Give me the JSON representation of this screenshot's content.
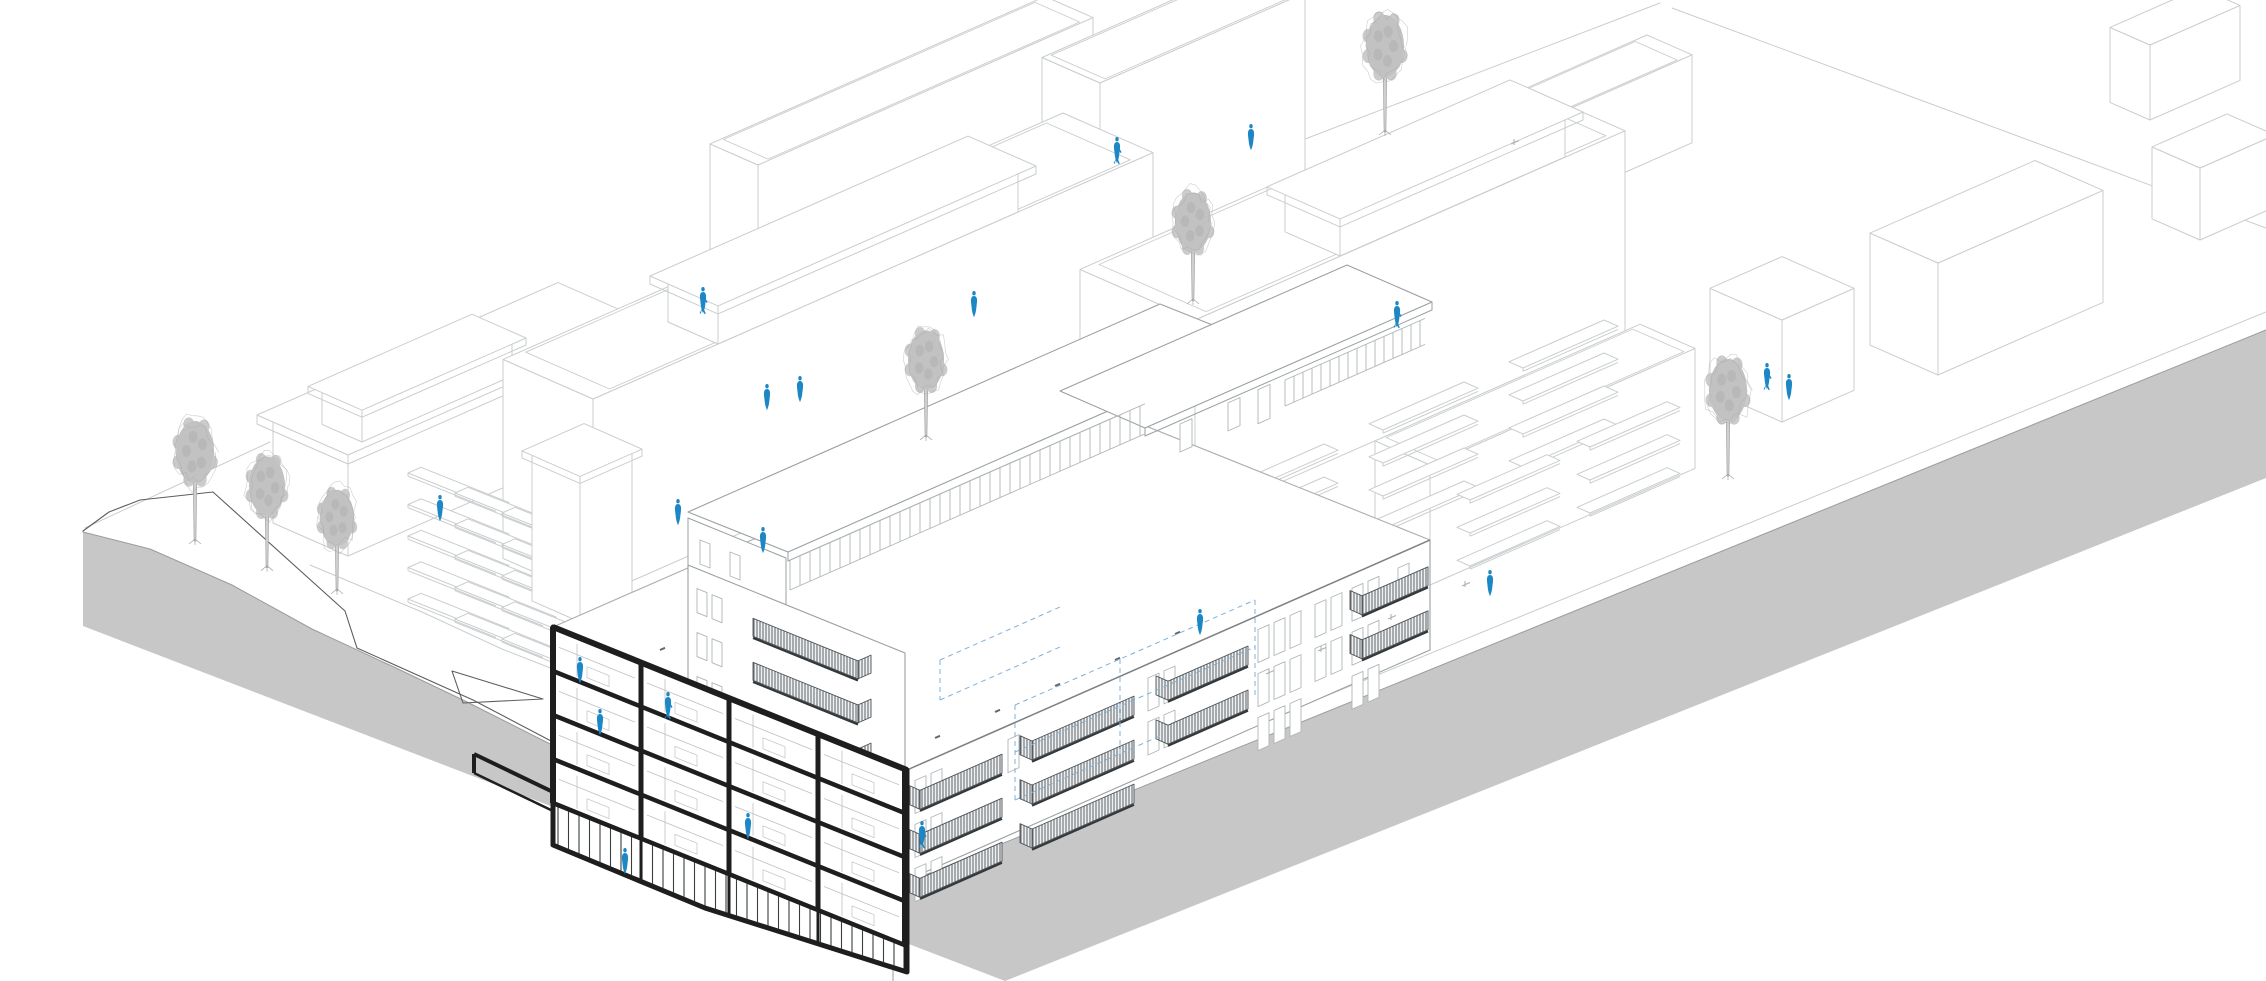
{
  "scene": {
    "width": 2266,
    "height": 981,
    "slopes": {
      "e1": 0.44,
      "e2": 0.4
    },
    "colors": {
      "bg": "#ffffff",
      "lineLight": "#c9cdcf",
      "lineMid": "#a9aeb1",
      "lineDark": "#5b5f61",
      "black": "#1e1e1e",
      "plinth": "#c7c7c7",
      "plinthEdge": "#9c9c9c",
      "treeFill": "#c2c2c2",
      "treeMottle": "#adadad",
      "treeStroke": "#a6a6a6",
      "person": "#1d87c6",
      "dash": "#7fb0d8",
      "hatchLine": "#5d6367",
      "hatchBg": "#eef0f1",
      "windowLine": "#b0b5b7",
      "interior": "#bcc1c3",
      "storefront": "#3a3e40",
      "dots": "#63686b",
      "facadeLine": "#9aa0a3",
      "roofEdge": "#7c8184"
    },
    "plinth": {
      "polygon": [
        [
          83,
          532
        ],
        [
          150,
          549
        ],
        [
          232,
          585
        ],
        [
          312,
          629
        ],
        [
          396,
          668
        ],
        [
          465,
          701
        ],
        [
          560,
          749
        ],
        [
          648,
          791
        ],
        [
          762,
          841
        ],
        [
          893,
          888
        ],
        [
          2266,
          330
        ],
        [
          2266,
          478
        ],
        [
          1005,
          981
        ],
        [
          83,
          626
        ]
      ],
      "topEdge": [
        [
          83,
          532
        ],
        [
          150,
          549
        ],
        [
          232,
          585
        ],
        [
          312,
          629
        ],
        [
          396,
          668
        ],
        [
          465,
          701
        ],
        [
          560,
          749
        ],
        [
          648,
          791
        ],
        [
          762,
          841
        ],
        [
          893,
          888
        ],
        [
          2266,
          330
        ]
      ],
      "cornerLine": [
        [
          893,
          888
        ],
        [
          893,
          981
        ]
      ]
    },
    "siteLines": [
      [
        [
          85,
          528
        ],
        [
          270,
          442
        ]
      ],
      [
        [
          1050,
          237
        ],
        [
          1172,
          190
        ],
        [
          1660,
          3
        ]
      ],
      [
        [
          1672,
          8
        ],
        [
          2266,
          228
        ]
      ],
      [
        [
          310,
          565
        ],
        [
          422,
          612
        ],
        [
          502,
          649
        ],
        [
          553,
          669
        ]
      ],
      [
        [
          900,
          870
        ],
        [
          2266,
          312
        ]
      ]
    ],
    "darkPaths": [
      [
        [
          140,
          500
        ],
        [
          213,
          492
        ],
        [
          345,
          611
        ],
        [
          357,
          648
        ],
        [
          473,
          700
        ],
        [
          572,
          752
        ],
        [
          664,
          800
        ],
        [
          790,
          851
        ],
        [
          893,
          888
        ]
      ],
      [
        [
          140,
          500
        ],
        [
          109,
          512
        ],
        [
          83,
          531
        ]
      ]
    ],
    "darkClosed": [
      [
        [
          452,
          671
        ],
        [
          543,
          699
        ],
        [
          463,
          703
        ]
      ]
    ],
    "boxes": [
      {
        "n": [
          758,
          270
        ],
        "l1": 335,
        "l2": 48,
        "h": 105,
        "parapet": true
      },
      {
        "n": [
          1100,
          300
        ],
        "l1": 205,
        "l2": 58,
        "h": 217,
        "parapet": true
      },
      {
        "n": [
          1312,
          310
        ],
        "l1": 380,
        "l2": 45,
        "h": 88,
        "parapet": true
      },
      {
        "n": [
          348,
          556
        ],
        "l1": 285,
        "l2": 75,
        "h": 108,
        "slab": {
          "o": 8,
          "th": 9
        }
      },
      {
        "n": [
          362,
          442
        ],
        "l1": 150,
        "l2": 40,
        "h": 38,
        "slab": {
          "o": 7,
          "th": 7
        }
      },
      {
        "n": [
          593,
          598
        ],
        "l1": 560,
        "l2": 90,
        "h": 199,
        "parapet": true
      },
      {
        "n": [
          718,
          344
        ],
        "l1": 300,
        "l2": 50,
        "h": 46,
        "slab": {
          "o": 9,
          "th": 8
        }
      },
      {
        "n": [
          1430,
          585
        ],
        "l1": 265,
        "l2": 55,
        "h": 120,
        "parapet": true
      },
      {
        "n": [
          1195,
          520
        ],
        "l1": 430,
        "l2": 115,
        "h": 200,
        "parapet": true
      },
      {
        "n": [
          1340,
          256
        ],
        "l1": 225,
        "l2": 55,
        "h": 45,
        "slab": {
          "o": 9,
          "th": 8
        }
      },
      {
        "n": [
          2150,
          120
        ],
        "l1": 90,
        "l2": 40,
        "h": 75
      },
      {
        "n": [
          2200,
          240
        ],
        "l1": 75,
        "l2": 48,
        "h": 72
      },
      {
        "n": [
          1938,
          375
        ],
        "l1": 165,
        "l2": 68,
        "h": 112
      },
      {
        "n": [
          1782,
          422
        ],
        "l1": 72,
        "l2": 72,
        "h": 102
      }
    ],
    "towerBox": {
      "n": [
        580,
        622
      ],
      "l1": 52,
      "l2": 48,
      "h": 150,
      "slab": {
        "o": 5,
        "th": 7
      }
    },
    "stripGrids": [
      {
        "base": [
          408,
          473
        ],
        "dir": "sw",
        "len": 88,
        "dep": 13,
        "cols": 3,
        "rows": 5,
        "colStep": [
          47,
          20
        ],
        "rowStep": [
          0,
          31.5
        ]
      },
      {
        "base": [
          1243,
          492
        ],
        "dir": "se",
        "len": 95,
        "dep": 14,
        "cols": 3,
        "rows": 4,
        "colStep": [
          140,
          -62
        ],
        "rowStep": [
          0,
          33
        ]
      },
      {
        "base": [
          960,
          430
        ],
        "dir": "se",
        "len": 100,
        "dep": 13,
        "cols": 2,
        "rows": 3,
        "colStep": [
          130,
          -57
        ],
        "rowStep": [
          0,
          33
        ]
      },
      {
        "base": [
          1470,
          500
        ],
        "dir": "se",
        "len": 90,
        "dep": 13,
        "cols": 2,
        "rows": 3,
        "colStep": [
          120,
          -53
        ],
        "rowStep": [
          0,
          33
        ]
      }
    ],
    "detail": {
      "roofQuad": [
        [
          553,
          627
        ],
        [
          907,
          770
        ],
        [
          1430,
          540
        ],
        [
          1076,
          398
        ]
      ],
      "roofDots": [
        [
          935,
          738
        ],
        [
          995,
          712
        ],
        [
          1055,
          686
        ],
        [
          1115,
          660
        ],
        [
          1175,
          634
        ],
        [
          975,
          747
        ],
        [
          1095,
          695
        ],
        [
          1215,
          643
        ],
        [
          720,
          665
        ],
        [
          660,
          650
        ]
      ],
      "atticSlabA": {
        "quad": [
          [
            688,
            512
          ],
          [
            1160,
            304
          ],
          [
            1260,
            344
          ],
          [
            788,
            552
          ]
        ],
        "th": 9
      },
      "atticSlabB": {
        "quad": [
          [
            1060,
            391
          ],
          [
            1347,
            265
          ],
          [
            1432,
            302
          ],
          [
            1145,
            428
          ]
        ],
        "th": 8
      },
      "clerestories": [
        {
          "x1": 790,
          "y1": 560,
          "len": 355,
          "slope": -0.44,
          "h": 30,
          "sp": 10
        },
        {
          "x1": 1285,
          "y1": 380,
          "len": 140,
          "slope": -0.44,
          "h": 26,
          "sp": 9
        }
      ],
      "atticWindows": {
        "lineX": 1180,
        "lineY": 424,
        "slope": -0.44,
        "xs": [
          1180,
          1228
        ],
        "doorX": 1258,
        "w": 12,
        "h": 28,
        "doorH": 34
      },
      "atticEndWall": {
        "quad": [
          [
            688,
            518
          ],
          [
            786,
            558
          ],
          [
            786,
            624
          ],
          [
            688,
            584
          ]
        ],
        "windows": [
          [
            700,
            540
          ],
          [
            730,
            552
          ]
        ],
        "ww": 10,
        "wh": 24
      },
      "wing": {
        "quad": [
          [
            688,
            565
          ],
          [
            905,
            653
          ],
          [
            905,
            770
          ],
          [
            688,
            683
          ]
        ],
        "edge": {
          "x": 688,
          "y": 565,
          "s": 0.405
        },
        "rails": {
          "x": 753,
          "w": 105,
          "rows": [
            27,
            71,
            115
          ],
          "h": 18,
          "retD": 13
        },
        "windows": {
          "x": 697,
          "n": 2,
          "rows": [
            20,
            64,
            108
          ],
          "w": 10,
          "h": 24,
          "gap": 5
        }
      },
      "facade": {
        "quad": [
          [
            907,
            770
          ],
          [
            1430,
            540
          ],
          [
            1430,
            650
          ],
          [
            907,
            880
          ]
        ],
        "edge": {
          "x": 907,
          "y": 770,
          "s": -0.44
        },
        "windowRows": {
          "1": 14,
          "2": 58,
          "3": 102
        },
        "windowGroups": [
          {
            "x": 915,
            "n": 2,
            "rows": [
              1,
              2,
              3
            ]
          },
          {
            "x": 1008,
            "n": 1,
            "rows": [
              1
            ]
          },
          {
            "x": 1148,
            "n": 2,
            "rows": [
              1,
              2
            ]
          },
          {
            "x": 1258,
            "n": 3,
            "rows": [
              1,
              2,
              3
            ]
          },
          {
            "x": 1315,
            "n": 2,
            "rows": [
              1,
              2
            ]
          },
          {
            "x": 1352,
            "n": 2,
            "rows": [
              1,
              2,
              3
            ]
          },
          {
            "x": 1398,
            "n": 1,
            "rows": [
              1
            ]
          }
        ],
        "winW": 11,
        "winH": 33,
        "winGap": 5,
        "balconies": [
          {
            "x": 920,
            "w": 82,
            "rows": [
              26,
              70,
              114
            ]
          },
          {
            "x": 1032,
            "w": 102,
            "rows": [
              26,
              70,
              114
            ]
          },
          {
            "x": 1168,
            "w": 80,
            "rows": [
              26,
              70
            ]
          },
          {
            "x": 1362,
            "w": 66,
            "rows": [
              26,
              70
            ]
          }
        ],
        "railH": 19,
        "retD": 12
      },
      "dashes": [
        [
          1015,
          705,
          1255,
          600
        ],
        [
          1015,
          752,
          1255,
          647
        ],
        [
          1015,
          800,
          1160,
          736
        ],
        [
          1015,
          705,
          1015,
          800
        ],
        [
          1120,
          659,
          1120,
          754
        ],
        [
          1255,
          600,
          1255,
          695
        ],
        [
          940,
          660,
          1060,
          607
        ],
        [
          940,
          700,
          1060,
          647
        ],
        [
          940,
          660,
          940,
          700
        ]
      ],
      "section": {
        "quad": [
          [
            553,
            627
          ],
          [
            907,
            770
          ],
          [
            907,
            972
          ],
          [
            705,
            908
          ],
          [
            553,
            845
          ]
        ],
        "edge": {
          "x": 553,
          "y": 627,
          "s": 0.404
        },
        "floors": [
          0,
          44,
          88,
          132,
          176
        ],
        "cols": [
          553,
          641,
          729,
          818,
          905
        ],
        "colW": [
          6,
          5,
          5,
          5,
          6
        ],
        "storefrontTop": 176,
        "bottom": [
          [
            553,
            845
          ],
          [
            705,
            908
          ],
          [
            907,
            972
          ]
        ],
        "mullionSp": 10.5,
        "steps": [
          [
            553,
            792,
            474,
            754,
            4
          ],
          [
            474,
            754,
            474,
            773,
            4
          ],
          [
            474,
            773,
            553,
            811,
            2.5
          ]
        ]
      }
    },
    "ticks": [
      [
        1322,
        649
      ],
      [
        1392,
        617
      ],
      [
        1466,
        584
      ],
      [
        1270,
        672
      ],
      [
        1515,
        142
      ]
    ],
    "trees": [
      {
        "x": 1385,
        "y": 46,
        "s": 1.0,
        "t": 55
      },
      {
        "x": 1193,
        "y": 222,
        "s": 0.95,
        "t": 52
      },
      {
        "x": 926,
        "y": 360,
        "s": 0.95,
        "t": 50
      },
      {
        "x": 195,
        "y": 452,
        "s": 1.0,
        "t": 58
      },
      {
        "x": 267,
        "y": 486,
        "s": 0.95,
        "t": 55
      },
      {
        "x": 337,
        "y": 518,
        "s": 0.9,
        "t": 50
      },
      {
        "x": 1728,
        "y": 390,
        "s": 1.0,
        "t": 55
      }
    ],
    "people": [
      {
        "x": 703,
        "y": 312,
        "v": "w"
      },
      {
        "x": 767,
        "y": 409
      },
      {
        "x": 800,
        "y": 401
      },
      {
        "x": 974,
        "y": 316
      },
      {
        "x": 1117,
        "y": 162,
        "v": "w"
      },
      {
        "x": 1251,
        "y": 149
      },
      {
        "x": 1397,
        "y": 326,
        "v": "w"
      },
      {
        "x": 1767,
        "y": 388,
        "v": "w"
      },
      {
        "x": 1789,
        "y": 399
      },
      {
        "x": 440,
        "y": 520
      },
      {
        "x": 678,
        "y": 524
      },
      {
        "x": 763,
        "y": 552
      },
      {
        "x": 580,
        "y": 682
      },
      {
        "x": 668,
        "y": 717,
        "v": "w"
      },
      {
        "x": 600,
        "y": 734
      },
      {
        "x": 748,
        "y": 838
      },
      {
        "x": 625,
        "y": 873
      },
      {
        "x": 922,
        "y": 846,
        "v": "w"
      },
      {
        "x": 1200,
        "y": 634
      },
      {
        "x": 1490,
        "y": 595
      }
    ]
  }
}
